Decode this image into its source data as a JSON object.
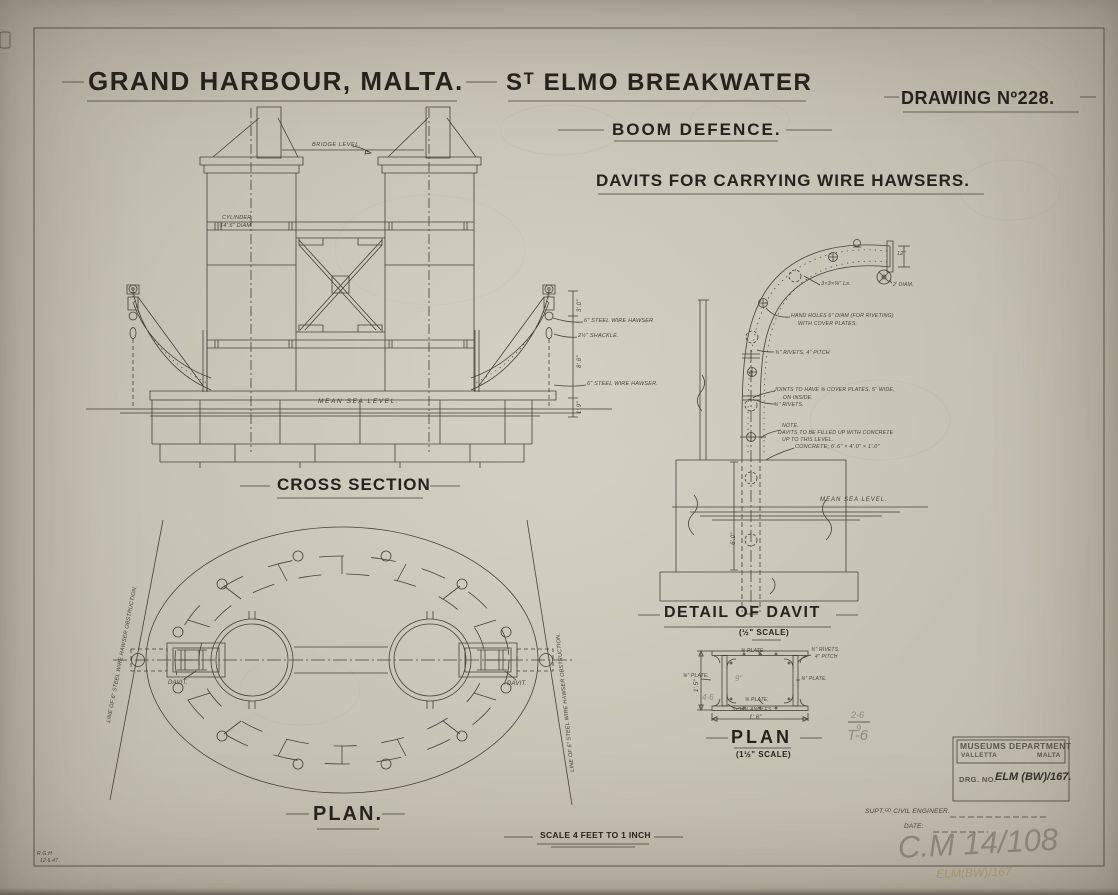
{
  "colors": {
    "paper": "#c6c2b4",
    "ink": "#38352c",
    "pencil": "#8f8c81",
    "pencil_yellow": "#b2a577",
    "stamp_ink": "#5b584e",
    "red_tag": "#78291b"
  },
  "header": {
    "title_left": "GRAND HARBOUR, MALTA.",
    "title_right": "Sᵀ ELMO BREAKWATER",
    "drawing_no": "DRAWING Nº228.",
    "subtitle": "BOOM DEFENCE.",
    "subtitle2": "DAVITS FOR CARRYING WIRE HAWSERS."
  },
  "cross_section": {
    "bridge_level": "BRIDGE LEVEL.",
    "cylinder_line1": "CYLINDER",
    "cylinder_line2": "14'.6\" DIAM.",
    "mean_sea_level": "MEAN SEA LEVEL.",
    "hawser_upper": "6\" STEEL WIRE HAWSER",
    "shackle": "2½\" SHACKLE.",
    "hawser_lower": "6\" STEEL WIRE HAWSER.",
    "dim_top": "3'.0\"",
    "dim_mid": "8'.6\"",
    "dim_bottom": "1'.9\"",
    "title": "CROSS SECTION"
  },
  "plan": {
    "title": "PLAN.",
    "davit_left": "DAVIT.",
    "davit_right": "DAVIT.",
    "obstruction_left": "LINE OF 6\" STEEL WIRE HAWSER OBSTRUCTION.",
    "obstruction_right": "LINE OF 6\" STEEL WIRE HAWSER OBSTRUCTION."
  },
  "davit_detail": {
    "title": "DETAIL OF DAVIT",
    "scale": "(½\" SCALE)",
    "dim_12": "12\"",
    "sheave": "2' DIAM.",
    "angles": "3×3×⅜\" Ls.",
    "hand_holes_1": "HAND HOLES 6\" DIAM (FOR RIVETING)",
    "hand_holes_2": "WITH COVER PLATES.",
    "rivets": "¾\" RIVETS. 4\" PITCH",
    "joints_1": "JOINTS TO HAVE ⅜ COVER PLATES, 5\" WIDE,",
    "joints_2": "ON INSIDE.",
    "joints_3": "¾\" RIVETS.",
    "note_1": "NOTE.",
    "note_2": "DAVITS TO BE FILLED UP WITH CONCRETE",
    "note_3": "UP TO THIS LEVEL.",
    "concrete": "CONCRETE; 6'.6\" × 4'.0\" × 1'.0\"",
    "mean_sea_level": "MEAN SEA LEVEL.",
    "dim_6_0": "6'.0\""
  },
  "section_plan": {
    "title": "PLAN",
    "scale": "(1½\" SCALE)",
    "plate_top": "⅜ PLATE.",
    "rivets_1": "¾\" RIVETS.",
    "rivets_2": "4\" PITCH",
    "plate_left": "⅜\" PLATE.",
    "plate_right": "⅜\" PLATE.",
    "plate_bottom": "⅜ PLATE.",
    "angles": "3×3×⅜ ANGLES.",
    "dim_height": "1'.5\"",
    "dim_width": "1'.6\""
  },
  "stamp": {
    "dept": "MUSEUMS DEPARTMENT",
    "city": "VALLETTA",
    "country": "MALTA",
    "drg_label": "DRG. NO.",
    "drg_value": "ELM (BW)/167.",
    "engineer_label": "SUPT.ᴳᴰ CIVIL ENGINEER.",
    "date_label": "DATE:"
  },
  "pencil": {
    "cm_ref": "C.M 14/108",
    "elm_ref": "ELM(BW)/167",
    "mark_9": "9\"",
    "mark_46": "4-6",
    "frac_top": "2-6",
    "frac_bottom": "9",
    "mark_t6": "T-6"
  },
  "footer": {
    "scale_note": "SCALE 4 FEET TO 1 INCH",
    "initials": "R.G.H",
    "date": "12.6.47"
  }
}
